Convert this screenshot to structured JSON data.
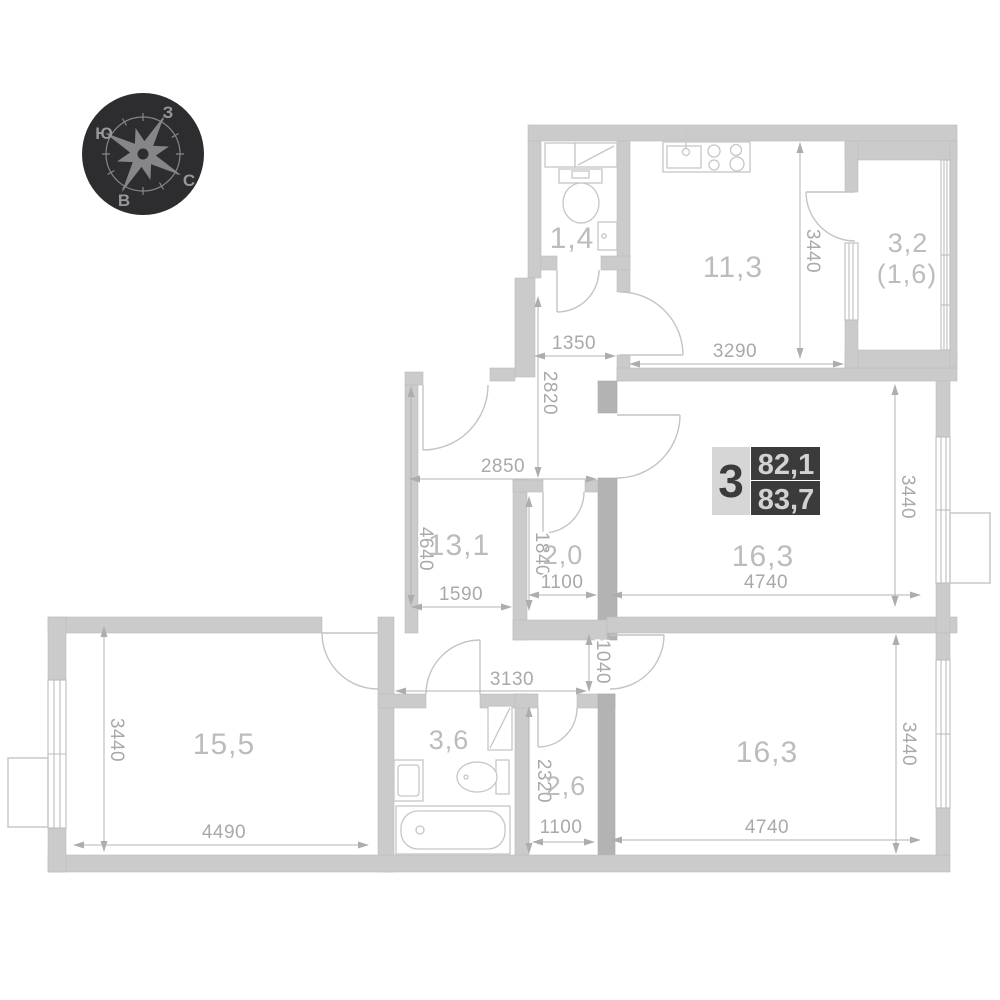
{
  "apartment": {
    "rooms_count": "3",
    "living_area": "82,1",
    "total_area": "83,7"
  },
  "compass": {
    "north": "С",
    "south": "Ю",
    "west": "З",
    "east": "В"
  },
  "rooms": {
    "wc": "1,4",
    "kitchen": "11,3",
    "balcony": "3,2",
    "balcony_reduced": "(1,6)",
    "hallway": "13,1",
    "wardrobe": "2,0",
    "room_mid": "16,3",
    "room_left": "15,5",
    "bathroom": "3,6",
    "closet": "2,6",
    "room_bottom": "16,3"
  },
  "dims": {
    "kitchen_h": "3440",
    "kitchen_w": "3290",
    "vestibule_w": "1350",
    "vestibule_h": "2820",
    "hall_w": "2850",
    "hall_h": "4640",
    "hall_bottom_w": "1590",
    "wardrobe_h": "1840",
    "wardrobe_w": "1100",
    "room_mid_w": "4740",
    "room_mid_h": "3440",
    "passage_w": "3130",
    "passage_h": "1040",
    "room_left_h": "3440",
    "room_left_w": "4490",
    "closet_h": "2320",
    "closet_w": "1100",
    "room_bottom_w": "4740",
    "room_bottom_h": "3440"
  }
}
